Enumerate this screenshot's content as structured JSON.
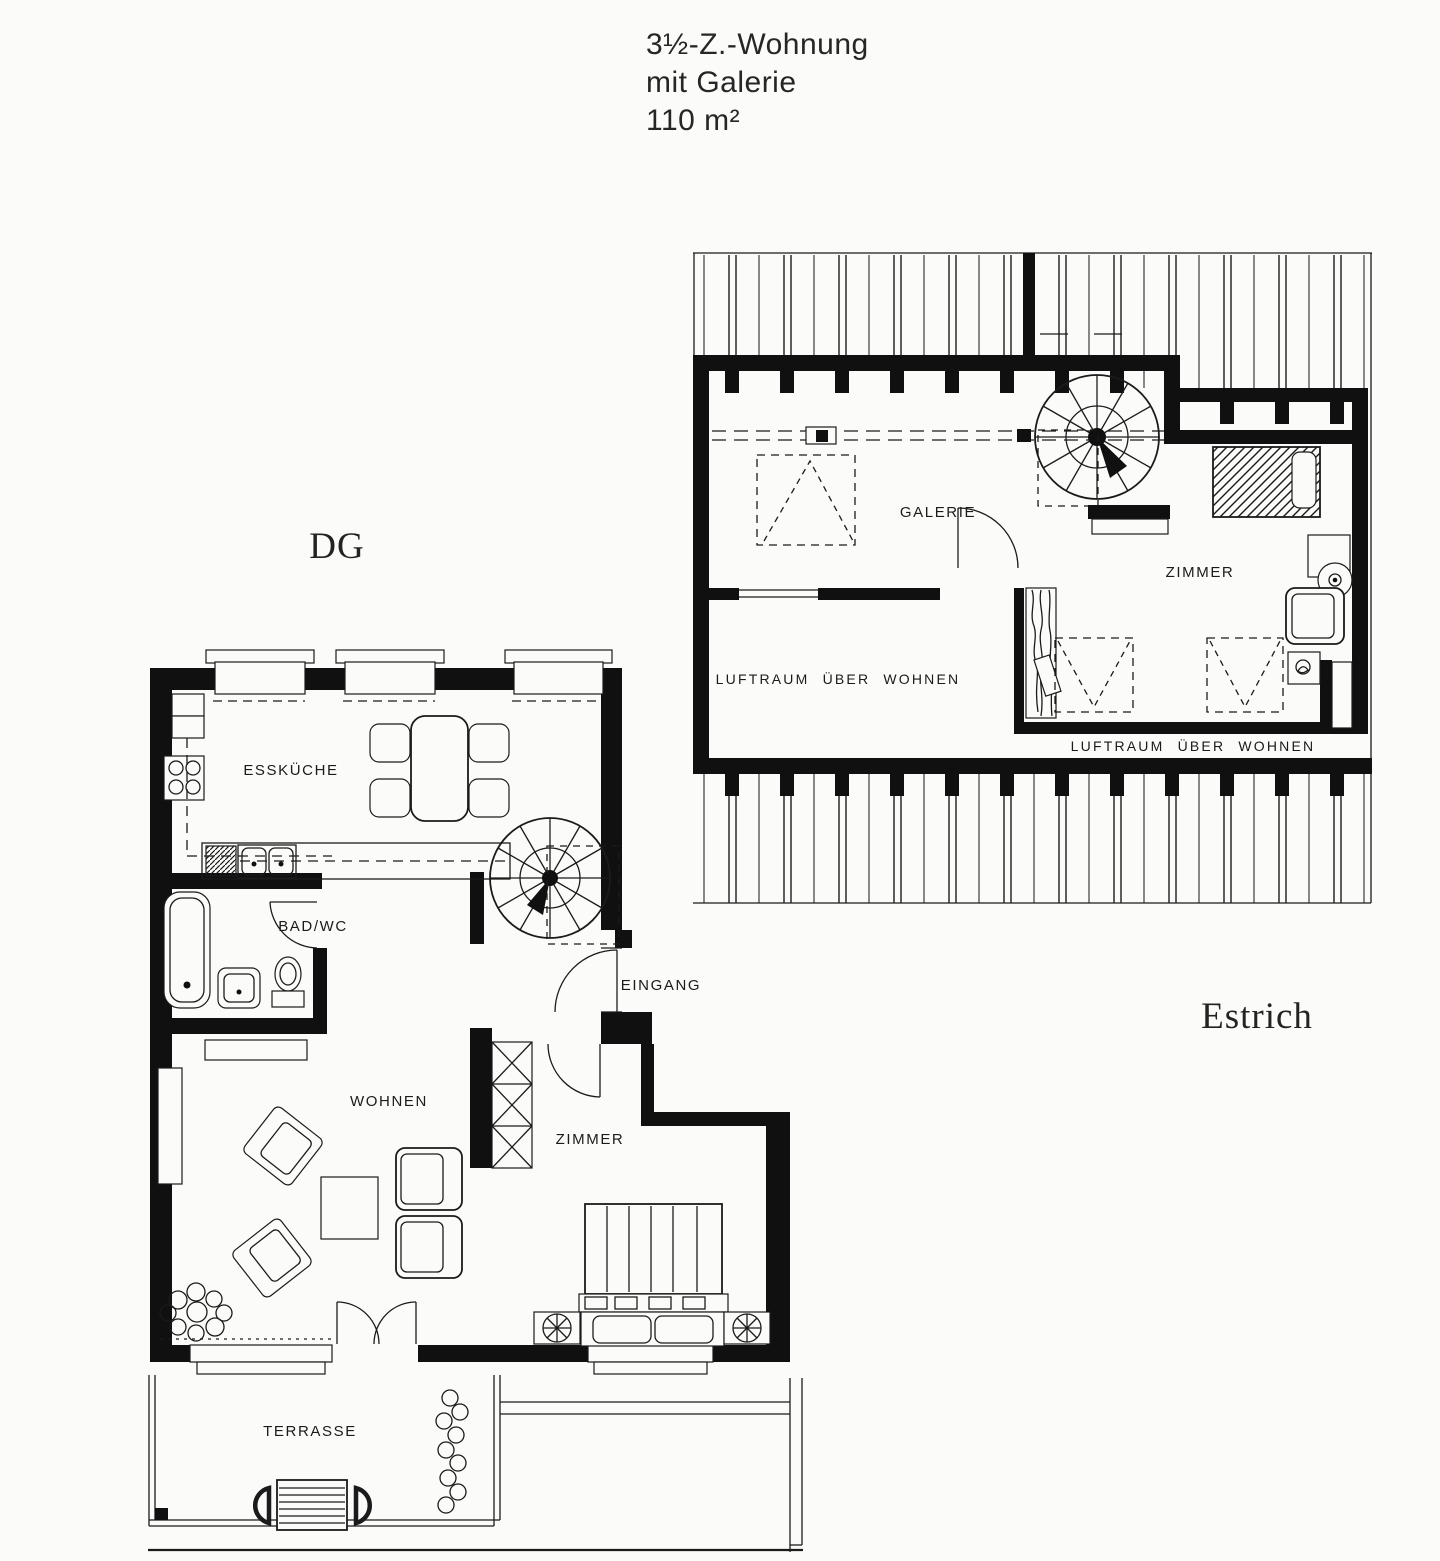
{
  "page": {
    "background": "#fbfbf9",
    "ink": "#1b1b1b",
    "wall_color": "#101010"
  },
  "title": {
    "line1": "3½-Z.-Wohnung",
    "line2": "mit Galerie",
    "line3": "110 m²"
  },
  "floor_labels": {
    "upper_floor": "DG",
    "attic": "Estrich"
  },
  "dg_rooms": {
    "esskueche": "ESSKÜCHE",
    "bad_wc": "BAD/WC",
    "eingang": "EINGANG",
    "wohnen": "WOHNEN",
    "zimmer": "ZIMMER",
    "terrasse": "TERRASSE"
  },
  "estrich_rooms": {
    "galerie": "GALERIE",
    "zimmer": "ZIMMER",
    "luftraum_left": "LUFTRAUM ÜBER WOHNEN",
    "luftraum_right": "LUFTRAUM ÜBER WOHNEN"
  }
}
